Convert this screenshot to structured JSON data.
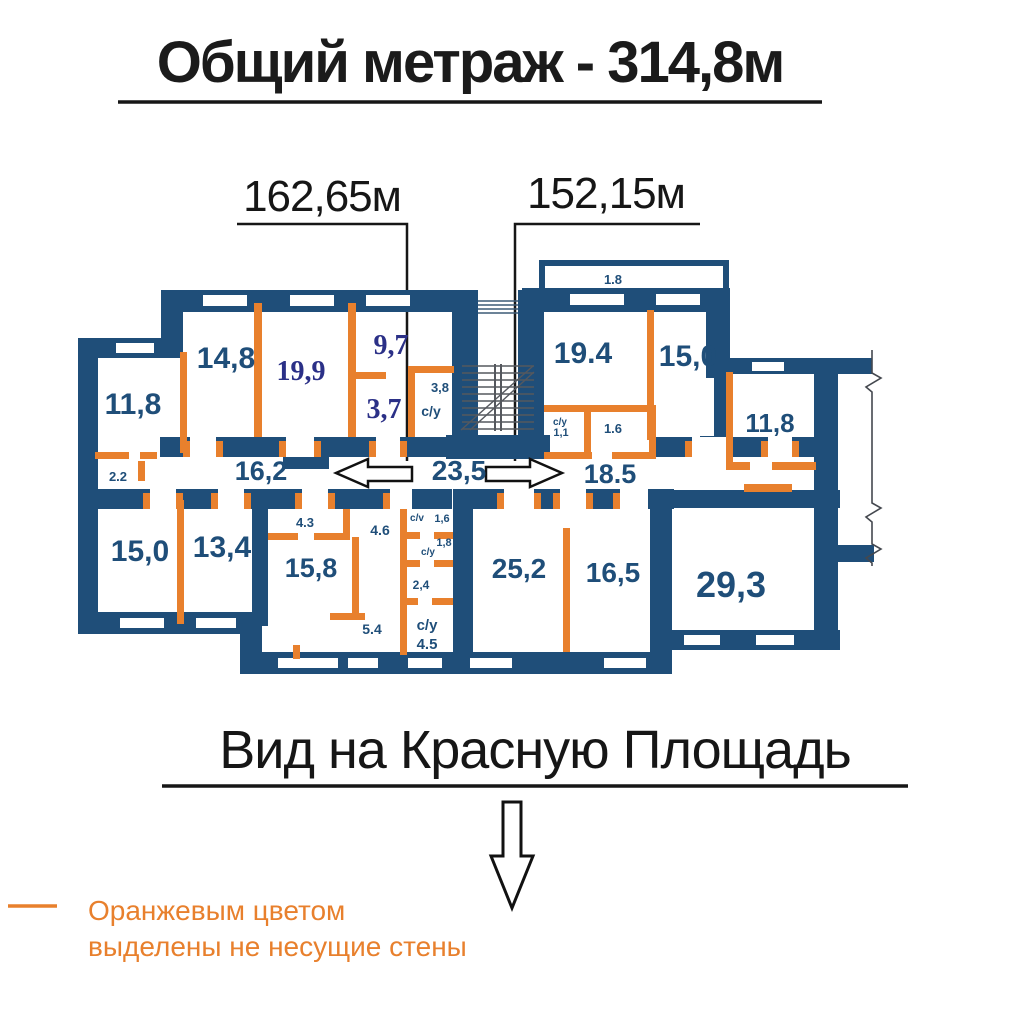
{
  "header": {
    "title": "Общий метраж - 314,8м"
  },
  "measurements": {
    "left_wing": "162,65м",
    "right_wing": "152,15м"
  },
  "plan": {
    "balcony_width": "1.8",
    "labels": {
      "r11_8L": "11,8",
      "r14_8": "14,8",
      "r19_9": "19,9",
      "r9_7": "9,7",
      "r3_7": "3,7",
      "r3_8": "3,8",
      "su_top": "с/у",
      "r2_2": "2.2",
      "h16_2": "16,2",
      "h23_5": "23,5",
      "r19_4": "19.4",
      "r15_0tr": "15,0",
      "r11_8R": "11,8",
      "su_11": "с/у",
      "r1_1": "1,1",
      "r1_6R": "1.6",
      "h18_5": "18.5",
      "r15_0bl": "15,0",
      "r13_4": "13,4",
      "r4_3": "4.3",
      "r4_6": "4.6",
      "r15_8": "15,8",
      "sv": "с/v",
      "r1_6L": "1,6",
      "su_mid": "с/у",
      "r1_8": "1,8",
      "r2_4": "2,4",
      "r5_4": "5.4",
      "su_45": "с/у",
      "r4_5": "4.5",
      "r25_2": "25,2",
      "r16_5": "16,5",
      "r29_3": "29,3"
    }
  },
  "footer": {
    "caption": "Вид на Красную Площадь"
  },
  "legend": {
    "line1": "Оранжевым цветом",
    "line2": "выделены не несущие стены"
  },
  "colors": {
    "load_bearing_wall": "#1F4E79",
    "non_bearing_wall": "#E8802D",
    "room_label": "#1F4E79",
    "accent_room_label": "#2B3087",
    "legend_text": "#E8802D"
  }
}
